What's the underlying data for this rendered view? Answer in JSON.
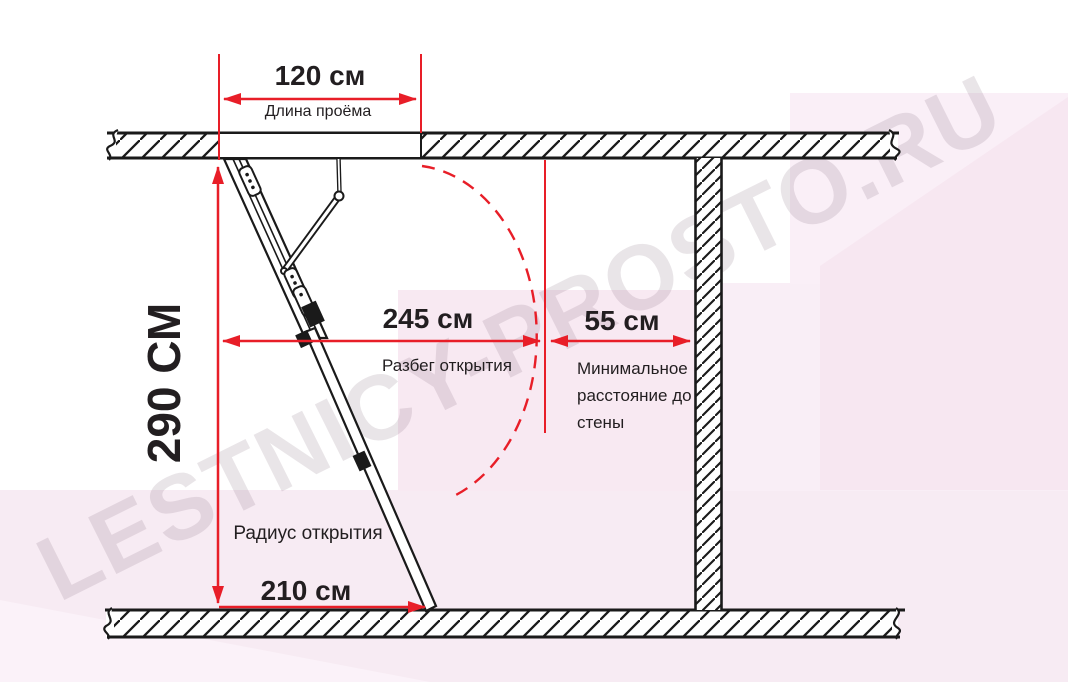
{
  "watermark_text": "LESTNICY-PROSTO.RU",
  "colors": {
    "dimension_red": "#e81e28",
    "line_black": "#1a1a1a",
    "background_pink": "#f7ebf3",
    "watermark_gray": "rgba(118,92,114,0.16)"
  },
  "dimensions": {
    "opening": {
      "value": "120 см",
      "label": "Длина проёма"
    },
    "ceiling_height": {
      "value": "290 СМ"
    },
    "opening_run": {
      "value": "245 см",
      "label": "Разбег открытия"
    },
    "wall_clearance": {
      "value": "55 см",
      "label": "Минимальное расстояние до стены"
    },
    "opening_radius": {
      "value": "210 см",
      "label": "Радиус открытия"
    }
  }
}
